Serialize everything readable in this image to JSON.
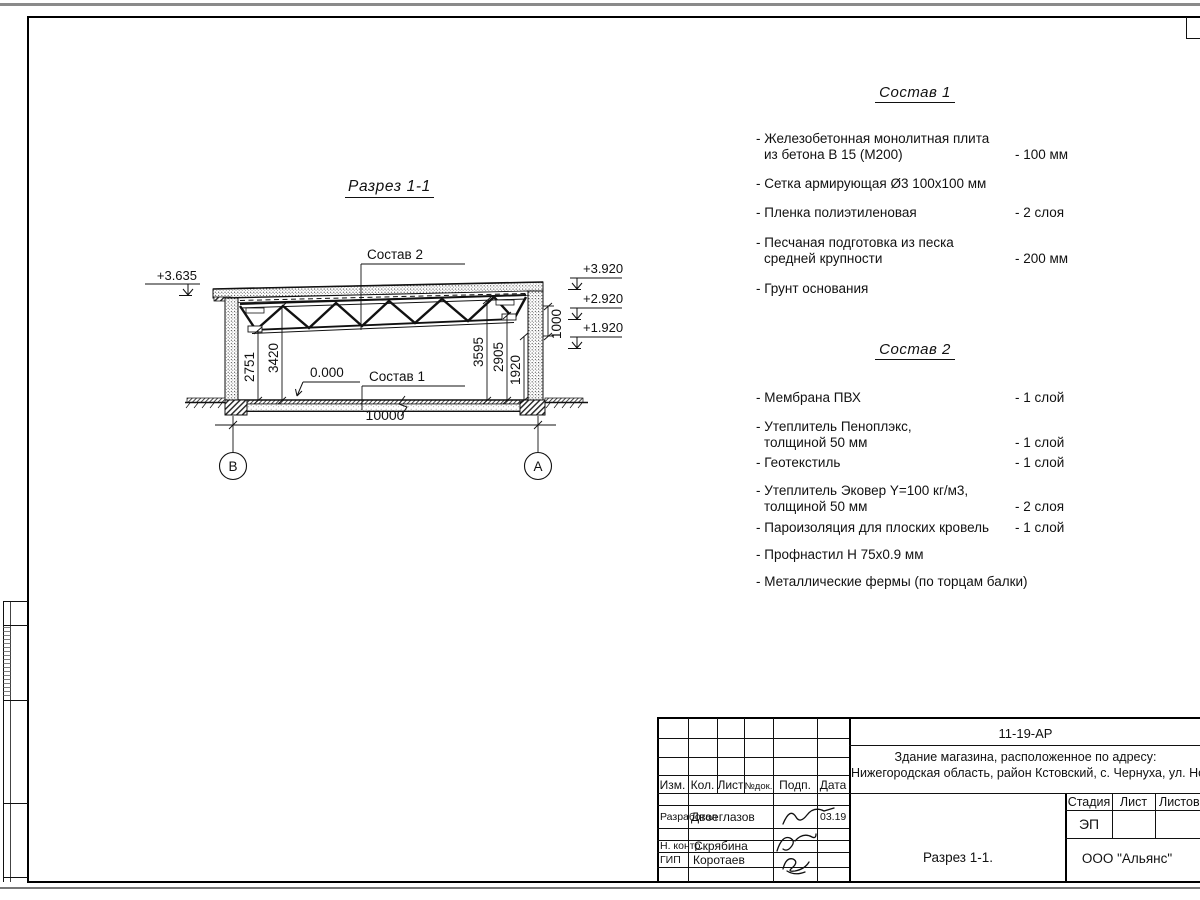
{
  "colors": {
    "line": "#111111",
    "paper_edge": "#8a8a8a"
  },
  "section": {
    "title": "Разрез 1-1",
    "labels": {
      "sostav2": "Состав 2",
      "sostav1": "Состав 1",
      "zero_level": "0.000"
    },
    "elevations": {
      "left": "+3.635",
      "right1": "+3.920",
      "right2": "+2.920",
      "right3": "+1.920"
    },
    "dims": {
      "d2751": "2751",
      "d3420": "3420",
      "d3595": "3595",
      "d2905": "2905",
      "d1920": "1920",
      "d1000": "1000",
      "span": "10000"
    },
    "axes": {
      "left": "В",
      "right": "А"
    }
  },
  "sostav1": {
    "title": "Состав 1",
    "items": [
      {
        "line1": "- Железобетонная  монолитная плита",
        "line2": "из бетона В 15 (М200)",
        "value": "- 100 мм"
      },
      {
        "line1": "- Сетка армирующая Ø3 100х100 мм"
      },
      {
        "line1": "- Пленка полиэтиленовая",
        "value": "-  2 слоя"
      },
      {
        "line1": "- Песчаная подготовка из песка",
        "line2": "средней крупности",
        "value": "- 200 мм"
      },
      {
        "line1": "- Грунт основания"
      }
    ]
  },
  "sostav2": {
    "title": "Состав 2",
    "items": [
      {
        "line1": "- Мембрана ПВХ",
        "value": "- 1 слой"
      },
      {
        "line1": "- Утеплитель Пеноплэкс,",
        "line2": "толщиной 50 мм",
        "value": "- 1 слой"
      },
      {
        "line1": "- Геотекстиль",
        "value": "- 1 слой"
      },
      {
        "line1": "- Утеплитель Эковер Y=100 кг/м3,",
        "line2": "толщиной 50 мм",
        "value": "- 2 слоя"
      },
      {
        "line1": "- Пароизоляция для плоских кровель",
        "value": "- 1 слой"
      },
      {
        "line1": "- Профнастил Н 75х0.9 мм"
      },
      {
        "line1": "- Металлические фермы (по торцам балки)"
      }
    ]
  },
  "titleblock": {
    "doc_number": "11-19-АР",
    "address_line1": "Здание магазина, расположенное по адресу:",
    "address_line2": "Нижегородская область, район Кстовский, с. Чернуха, ул. Нов",
    "headers": {
      "izm": "Изм.",
      "kol": "Кол.",
      "list": "Лист",
      "ndok": "№док.",
      "podp": "Подп.",
      "data": "Дата"
    },
    "rows": [
      {
        "role": "Разработал",
        "name": "Двоеглазов",
        "date": "03.19"
      },
      {
        "role": "Н. контр.",
        "name": "Скрябина"
      },
      {
        "role": "ГИП",
        "name": "Коротаев"
      }
    ],
    "stage_label": "Стадия",
    "sheet_label": "Лист",
    "sheets_label": "Листов",
    "stage_value": "ЭП",
    "drawing_name": "Разрез 1-1.",
    "company": "ООО \"Альянс\""
  }
}
